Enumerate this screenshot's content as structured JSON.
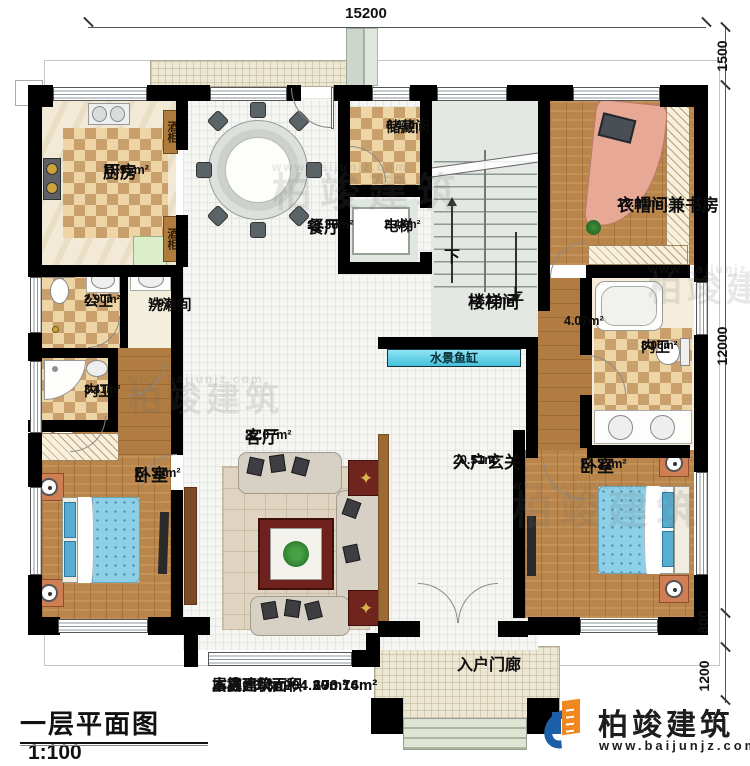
{
  "title_block": {
    "title": "一层平面图",
    "scale": "1:100"
  },
  "stats": [
    {
      "label": "本层建筑面积:",
      "value": "196.74m²"
    },
    {
      "label": "本栋建筑面积:",
      "value": "670.16m²"
    },
    {
      "label": "占地面积:",
      "value": "204.20m²"
    },
    {
      "label": "层高:",
      "value": "3.3m"
    }
  ],
  "dimensions": {
    "top": "15200",
    "right_upper": "1500",
    "right_main": "12000",
    "right_step": "800",
    "right_porch": "1200"
  },
  "rooms": {
    "kitchen": {
      "name": "厨房",
      "area": "11.95m²"
    },
    "dining": {
      "name": "餐厅",
      "area": "19.38m²"
    },
    "storage": {
      "name": "储藏间",
      "area": "3.41m²"
    },
    "elevator": {
      "name": "电梯",
      "area": "2.43m²"
    },
    "stairwell": {
      "name": "楼梯间",
      "area": "14.21m²"
    },
    "cloakroom_study": {
      "name": "衣帽间兼书房",
      "area": "12.91m²"
    },
    "ensuite_right": {
      "name": "内卫",
      "area": "8.06m²"
    },
    "hallway": {
      "area": "4.07m²"
    },
    "public_bath": {
      "name": "公卫",
      "area": "2.90m²"
    },
    "washroom": {
      "name": "洗漱间",
      "area": "1.92m²"
    },
    "ensuite_left": {
      "name": "内卫",
      "area": "3.41m²"
    },
    "bedroom_left": {
      "name": "卧室",
      "area": "14.38m²"
    },
    "living": {
      "name": "客厅",
      "area": "32.07m²"
    },
    "foyer": {
      "name": "入户玄关",
      "area": "20.51m²"
    },
    "bedroom_right": {
      "name": "卧室",
      "area": "14.22m²"
    },
    "porch": {
      "name": "入户门廊"
    }
  },
  "features": {
    "fish_tank": "水景鱼缸",
    "wine_cabinet_top": "酒柜",
    "wine_cabinet_bottom": "酒柜",
    "stair_up": "上",
    "stair_down": "下"
  },
  "branding": {
    "logo_text": "柏竣建筑",
    "website": "www.baijunjz.com"
  },
  "watermark": {
    "text": "柏竣建筑",
    "url": "www.baijunjz.com"
  }
}
